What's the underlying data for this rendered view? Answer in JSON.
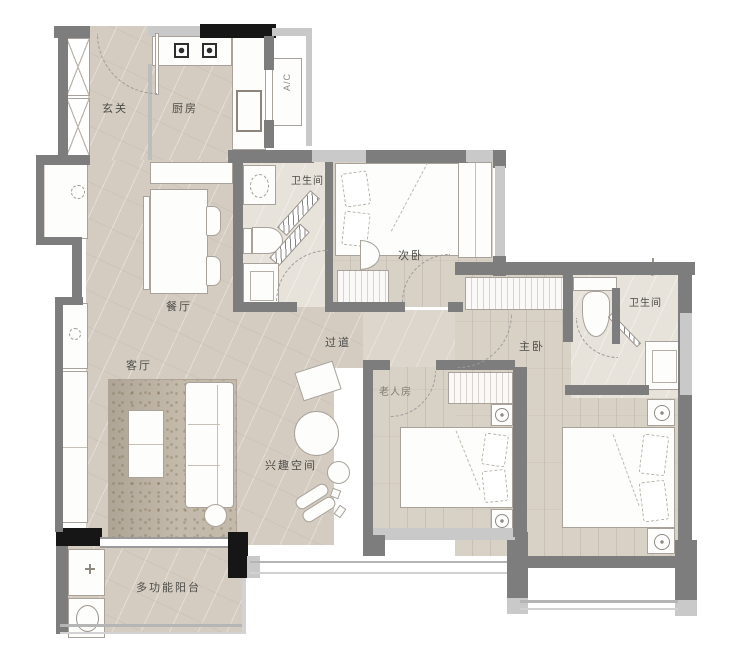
{
  "plan": {
    "labels": {
      "entry": "玄关",
      "kitchen": "厨房",
      "ac": "A/C",
      "bath1": "卫生间",
      "second_bedroom": "次卧",
      "dining": "餐厅",
      "hallway": "过道",
      "living": "客厅",
      "hobby": "兴趣空间",
      "elderly": "老人房",
      "master": "主卧",
      "master_bath": "卫生间",
      "balcony": "多功能阳台"
    },
    "colors": {
      "wall": "#7d7d7d",
      "wall_dark": "#161616",
      "win": "#c9c9c9",
      "floor_stone": "#d4ccc1",
      "floor_stone_light": "#ddd6cc",
      "floor_wood": "#d8d1c6",
      "floor_bath": "#e7e2da",
      "rug": "#c4baab",
      "ink": "#4c4c48"
    }
  }
}
